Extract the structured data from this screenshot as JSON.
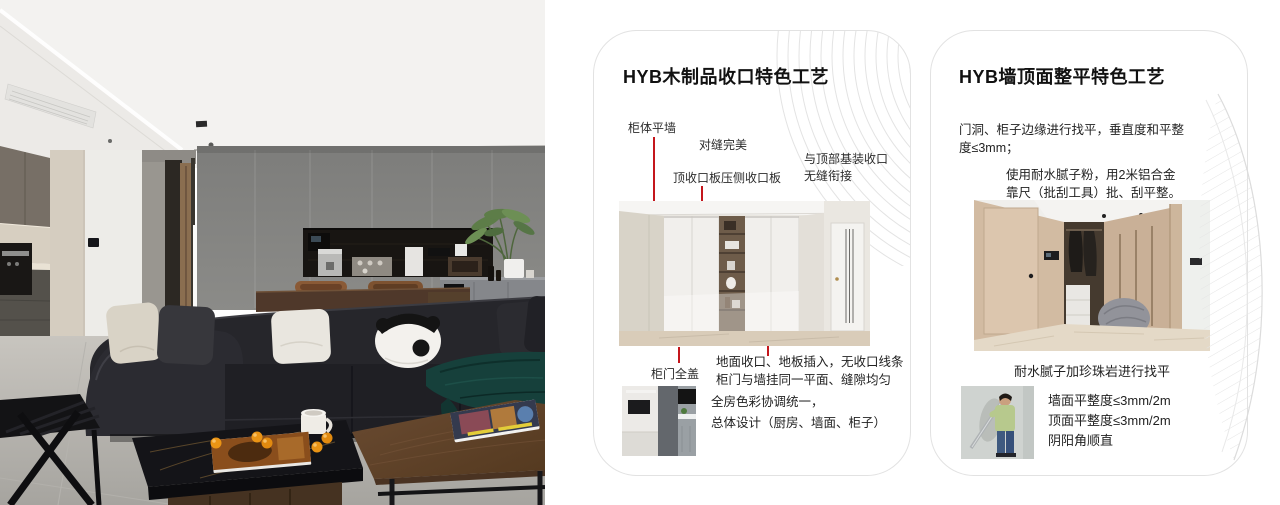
{
  "cards": {
    "wood": {
      "title": "HYB木制品收口特色工艺",
      "labels": {
        "wall": "柜体平墙",
        "seam": "对缝完美",
        "board": "顶收口板压侧收口板",
        "top1": "与顶部基装收口",
        "top2": "无缝衔接",
        "door": "柜门全盖"
      },
      "notes": {
        "floor1": "地面收口、地板插入，无收口线条",
        "floor2": "柜门与墙挂同一平面、缝隙均匀",
        "color1": "全房色彩协调统一，",
        "color2": "总体设计（厨房、墙面、柜子）"
      }
    },
    "wall": {
      "title": "HYB墙顶面整平特色工艺",
      "para1a": "门洞、柜子边缘进行找平，垂直度和平整",
      "para1b": "度≤3mm；",
      "para2a": "使用耐水腻子粉，用2米铝合金",
      "para2b": "靠尺（批刮工具）批、刮平整。",
      "caption": "耐水腻子加珍珠岩进行找平",
      "specs": [
        "墙面平整度≤3mm/2m",
        "顶面平整度≤3mm/2m",
        "阴阳角顺直"
      ]
    }
  },
  "colors": {
    "annotation_red": "#c4161c",
    "decor_line": "#e4e4e4",
    "card_border": "#e2e2e2"
  }
}
